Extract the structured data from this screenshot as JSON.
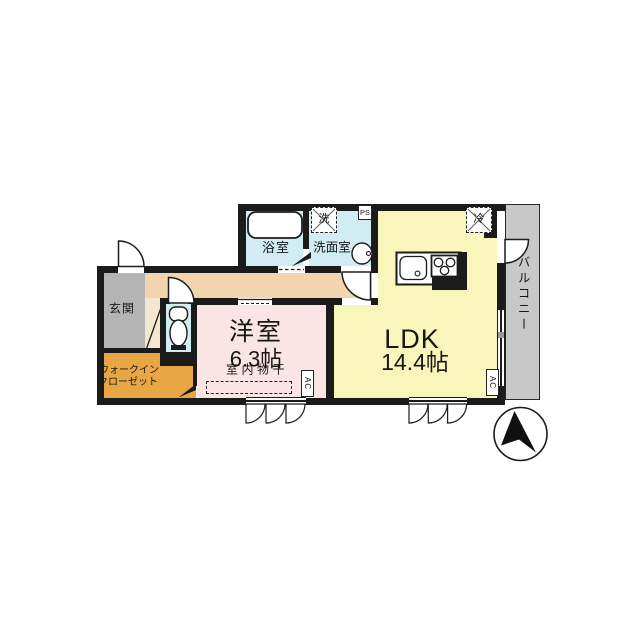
{
  "floor_plan": {
    "title": "1LDK apartment floor plan",
    "rooms": {
      "entrance": "玄関",
      "walk_in_closet_line1": "ウォークイン",
      "walk_in_closet_line2": "クローゼット",
      "western_room": "洋室",
      "western_room_size": "6.3帖",
      "ldk": "LDK",
      "ldk_size": "14.4帖",
      "bathroom": "浴室",
      "washroom": "洗面室",
      "balcony": "バルコニー"
    },
    "fixtures": {
      "washer": "洗",
      "fridge": "冷",
      "pipe_space": "PS",
      "air_con": "AC",
      "indoor_drying": "室内物干"
    },
    "colors": {
      "wall": "#1b1b1b",
      "ldk": "#f8f6bb",
      "western": "#fbe5e4",
      "hall": "#f2d4ae",
      "step": "#f5e7cf",
      "entrance_gray": "#b4b4b4",
      "wic": "#e8a744",
      "wet": "#d2edf2",
      "balcony": "#c8c8c8"
    }
  }
}
